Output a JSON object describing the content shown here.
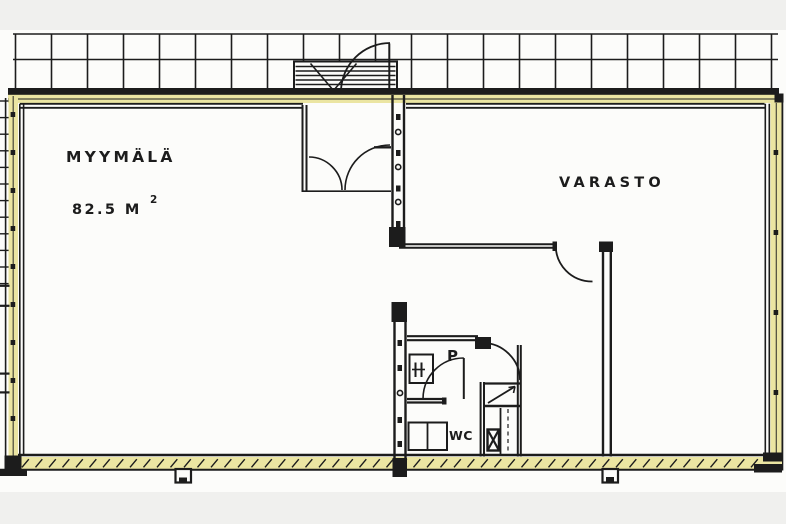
{
  "plan": {
    "title": "floor-plan",
    "rooms": {
      "shop": {
        "name": "MYYMÄLÄ",
        "area": "82.5 M",
        "area_sup": "2"
      },
      "storage": {
        "name": "VARASTO"
      },
      "p_room": {
        "name": "P"
      },
      "wc": {
        "name": "WC"
      }
    },
    "colors": {
      "wall_highlight": "#ebe5a2",
      "ink": "#1c1c1c",
      "paper": "#fcfcfa",
      "margin": "#f0f0ee"
    }
  }
}
